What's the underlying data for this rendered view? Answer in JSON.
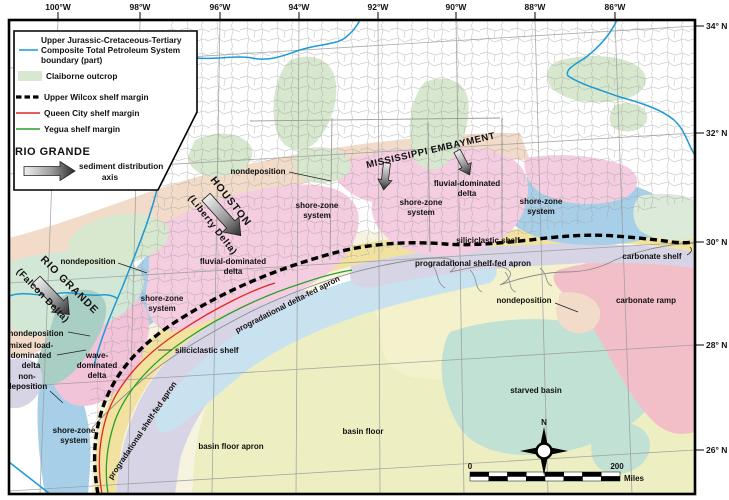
{
  "axes": {
    "top": [
      "100°W",
      "98°W",
      "96°W",
      "94°W",
      "92°W",
      "90°W",
      "88°W",
      "86°W"
    ],
    "right": [
      "34° N",
      "32° N",
      "30° N",
      "28° N",
      "26° N"
    ]
  },
  "legend": {
    "tps": [
      "Upper Jurassic-Cretaceous-Tertiary",
      "Composite Total Petroleum System",
      "boundary (part)"
    ],
    "claiborne": "Claiborne outcrop",
    "wilcox": "Upper Wilcox shelf margin",
    "queen_city": "Queen City shelf margin",
    "yegua": "Yegua shelf margin",
    "axis_title": "RIO GRANDE",
    "axis_desc": [
      "sediment distribution",
      "axis"
    ]
  },
  "map_labels": {
    "nondeposition": "nondeposition",
    "non_deposition": [
      "non-",
      "deposition"
    ],
    "mixed_load": [
      "mixed load-",
      "dominated",
      "delta"
    ],
    "mississippi_embayment": "MISSISSIPPI EMBAYMENT",
    "houston": "HOUSTON",
    "liberty_delta": "(Liberty Delta)",
    "rio_grande": "RIO GRANDE",
    "falcon_delta": "(Falcon Delta)",
    "fluvial_delta": [
      "fluvial-dominated",
      "delta"
    ],
    "shore_zone": [
      "shore-zone",
      "system"
    ],
    "wave_delta": [
      "wave-",
      "dominated",
      "delta"
    ],
    "siliciclastic_shelf": "siliciclastic shelf",
    "prograd_delta_fed": "progradational delta-fed apron",
    "prograd_shelf_fed": "progradational shelf-fed apron",
    "carbonate_shelf": "carbonate shelf",
    "carbonate_ramp": "carbonate ramp",
    "starved_basin": "starved basin",
    "basin_floor": "basin floor",
    "basin_floor_apron": "basin floor apron"
  },
  "scale_bar": {
    "zero": "0",
    "max": "200",
    "unit": "Miles"
  },
  "compass": {
    "north": "N"
  },
  "colors": {
    "tps_blue": "#1c9ad6",
    "queen_city_red": "#e02820",
    "yegua_green": "#2aa02a",
    "claiborne": "#d7e8cf",
    "peach": "#f2dcc9",
    "pink_delta": "#f5cde0",
    "wave_pink": "#f3c3da",
    "shore_blue": "#a8cfe8",
    "shelf_yellow": "#f1e2a0",
    "apron_lavender": "#d7d4e6",
    "apron_lightblue": "#c9e2f0",
    "basin_cream": "#f7f3e1",
    "basin_floor": "#edefc3",
    "la_yellow": "#f4f2cc",
    "starved_teal": "#c0e1d3",
    "carbonate_pink": "#f2bfc8",
    "left_green": "#d2e7d5",
    "right_green": "#dcead9",
    "mixed_teal": "#a9cfc4",
    "graticule": "#9a9a9a",
    "county": "#a0a0a0",
    "coast": "#8a8a8a"
  }
}
